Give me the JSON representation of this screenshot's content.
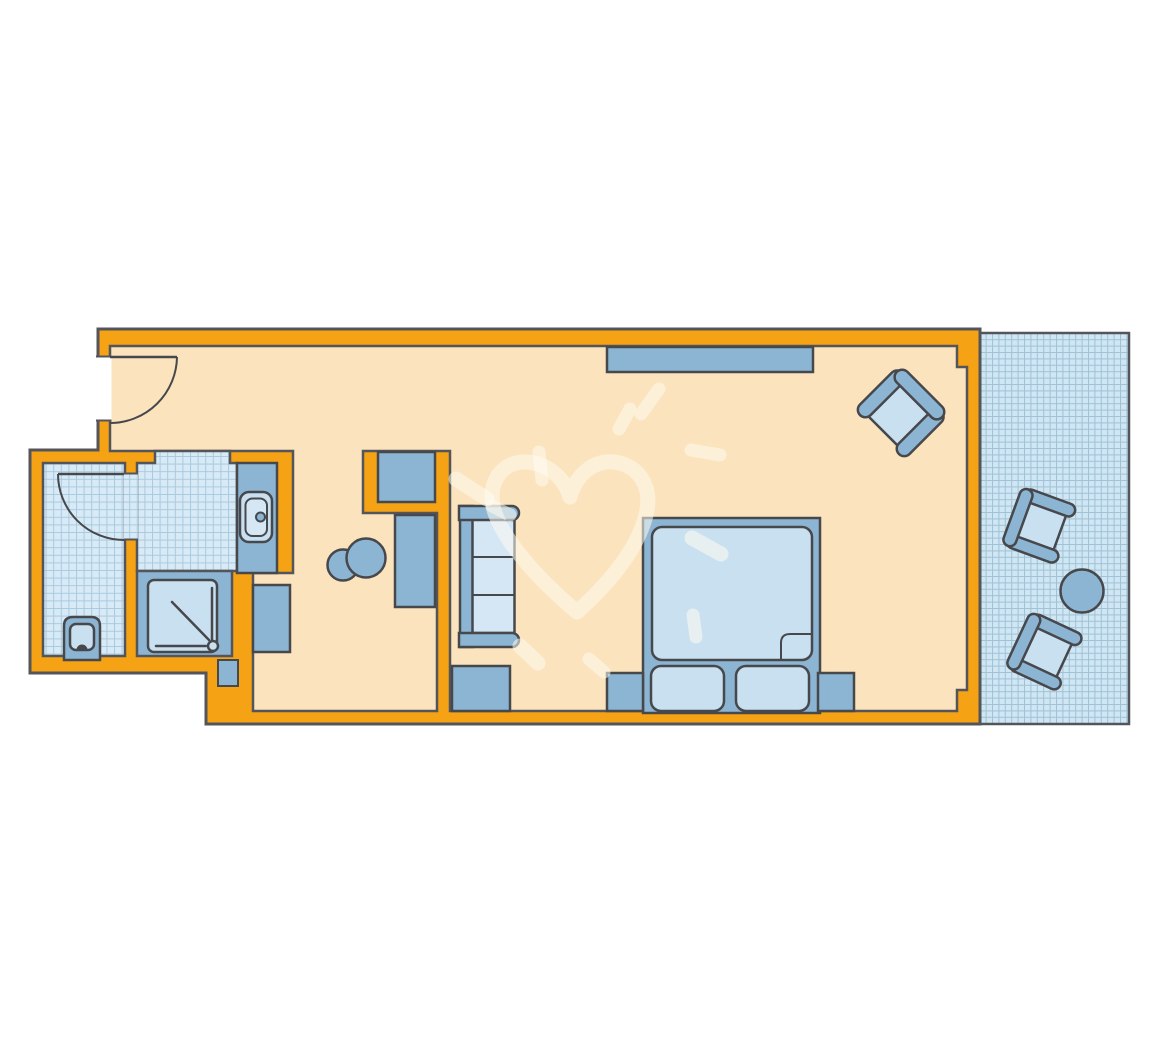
{
  "image": {
    "type": "architectural-floor-plan",
    "description": "Top-down floor plan of a hotel room: entrance corridor, bathroom block (WC, shower, washbasin vanity), hallway with wardrobe and minibar cabinet, combined sleeping/living area with double bed, sofa and armchair, and a tiled balcony with two chairs and a round table. A faint heart-and-sun doodle watermark overlays the plan."
  },
  "colors": {
    "background": "#ffffff",
    "wall": "#f5a314",
    "outline": "#54555b",
    "furniture_outline": "#47484c",
    "floor": "#fbe3bd",
    "tile_bg": "#d8eaf6",
    "tile_grid": "#a8cadf",
    "balcony_tile_bg": "#d0e6f2",
    "balcony_tile_grid": "#9ec2d8",
    "furniture": "#8cb5d4",
    "furniture_light": "#c9e0f1",
    "cushion_light": "#d5e7f5",
    "watermark": "#fffbf0"
  },
  "rooms": [
    {
      "name": "entrance-corridor"
    },
    {
      "name": "wc-room"
    },
    {
      "name": "shower-room"
    },
    {
      "name": "vanity-dressing-area"
    },
    {
      "name": "hallway"
    },
    {
      "name": "bedroom-living-area"
    },
    {
      "name": "balcony"
    }
  ],
  "furniture": [
    {
      "name": "entry-door"
    },
    {
      "name": "wc-door"
    },
    {
      "name": "toilet"
    },
    {
      "name": "shower-tray"
    },
    {
      "name": "washbasin"
    },
    {
      "name": "vanity-counter"
    },
    {
      "name": "luggage-bench"
    },
    {
      "name": "wardrobe"
    },
    {
      "name": "minibar-cabinet"
    },
    {
      "name": "stools"
    },
    {
      "name": "sofa"
    },
    {
      "name": "side-table"
    },
    {
      "name": "sideboard"
    },
    {
      "name": "double-bed"
    },
    {
      "name": "pillows"
    },
    {
      "name": "nightstands"
    },
    {
      "name": "armchair"
    },
    {
      "name": "balcony-chairs"
    },
    {
      "name": "balcony-table"
    }
  ]
}
